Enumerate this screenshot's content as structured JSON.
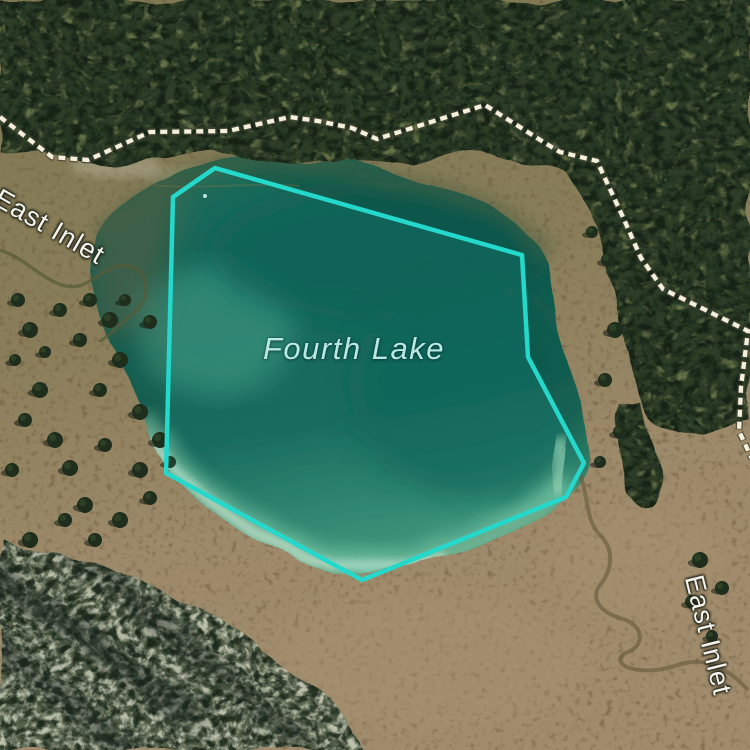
{
  "map": {
    "labels": {
      "lake": "Fourth Lake",
      "inlet_nw": "East Inlet",
      "inlet_se": "East Inlet"
    },
    "feature": {
      "name": "Fourth Lake",
      "type": "lake-boundary-highlight",
      "outline_color": "#24d8cc"
    },
    "trail": {
      "style": "dashed",
      "color": "#f4f0dc"
    },
    "colors": {
      "lake_deep": "#0f5a4e",
      "lake_shallow": "#7fbf9d",
      "forest": "#2e3d28",
      "meadow": "#9d8a6a",
      "label_lake": "#b9e8e5",
      "label_inlet": "#f4f4ee"
    }
  }
}
